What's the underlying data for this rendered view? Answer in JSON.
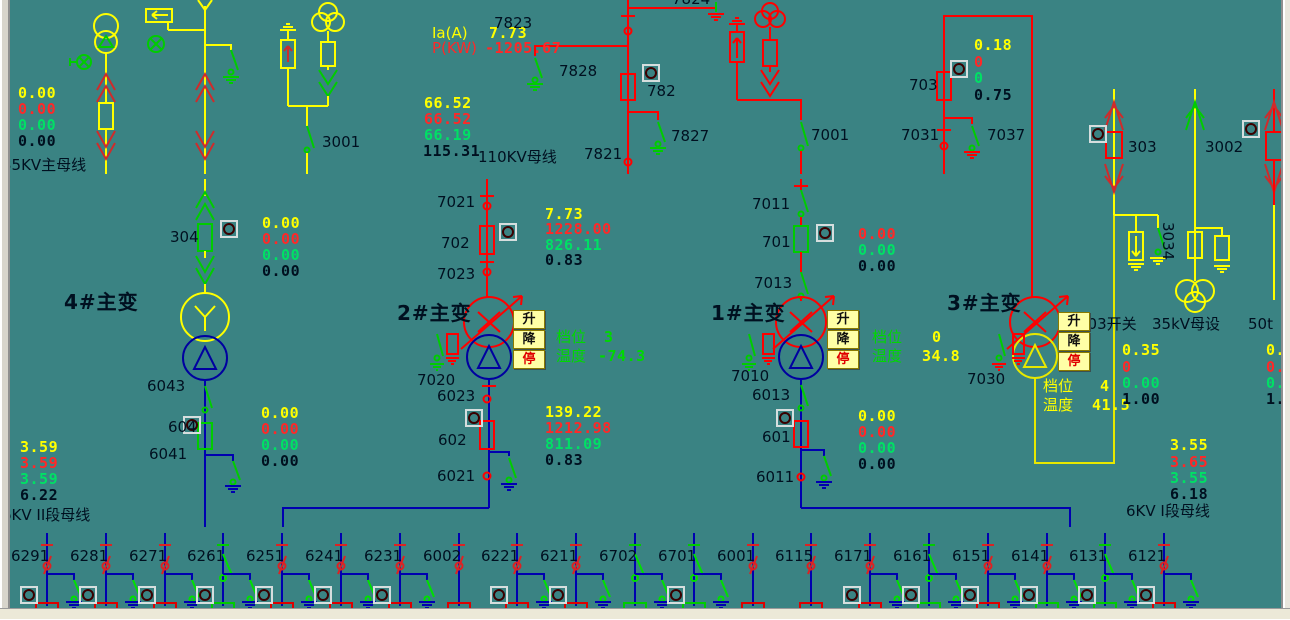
{
  "window": {
    "background": "#3a8383",
    "colors": {
      "yellow": "#ffff00",
      "red": "#ff2828",
      "green": "#00e065",
      "black": "#001020",
      "device_green": "#00cc00",
      "crimson": "#cf2b2b",
      "bus_blue": "#0000cc",
      "line_blue": "#0000b0",
      "navy": "#0000a0",
      "indicator_red": "#ff1515",
      "indicator_green": "#00d800",
      "button_bg": "#ffffa6"
    }
  },
  "tap_buttons": {
    "raise": "升",
    "lower": "降",
    "stop": "停",
    "stop_color": "#e00000",
    "text_color": "#101010"
  },
  "button_groups": [
    {
      "name": "t2-tap-controls",
      "x": 513,
      "y": 310
    },
    {
      "name": "t1-tap-controls",
      "x": 827,
      "y": 310
    },
    {
      "name": "t3-tap-controls",
      "x": 1058,
      "y": 312
    }
  ],
  "indicators": [
    {
      "n": "ind-304",
      "x": 221,
      "y": 221,
      "c": "r"
    },
    {
      "n": "ind-604",
      "x": 184,
      "y": 417,
      "c": "r"
    },
    {
      "n": "ind-702",
      "x": 500,
      "y": 224,
      "c": "r"
    },
    {
      "n": "ind-602",
      "x": 466,
      "y": 410,
      "c": "r"
    },
    {
      "n": "ind-701",
      "x": 817,
      "y": 225,
      "c": "r"
    },
    {
      "n": "ind-601",
      "x": 777,
      "y": 410,
      "c": "r"
    },
    {
      "n": "ind-782",
      "x": 643,
      "y": 65,
      "c": "r"
    },
    {
      "n": "ind-703",
      "x": 951,
      "y": 61,
      "c": "r"
    },
    {
      "n": "ind-303",
      "x": 1090,
      "y": 126,
      "c": "r"
    },
    {
      "n": "ind-50t",
      "x": 1243,
      "y": 121,
      "c": "r"
    }
  ],
  "feeders": {
    "bus_y": 533,
    "items": [
      {
        "id": "6291",
        "x": 47,
        "open": 0,
        "earth": 1,
        "ind": "r",
        "stub": "r"
      },
      {
        "id": "6281",
        "x": 106,
        "open": 0,
        "earth": 1,
        "ind": "r",
        "stub": "r"
      },
      {
        "id": "6271",
        "x": 165,
        "open": 0,
        "earth": 1,
        "ind": "r",
        "stub": "r"
      },
      {
        "id": "6261",
        "x": 223,
        "open": 1,
        "earth": 1,
        "ind": "g",
        "stub": "g"
      },
      {
        "id": "6251",
        "x": 282,
        "open": 0,
        "earth": 1,
        "ind": "r",
        "stub": "r"
      },
      {
        "id": "6241",
        "x": 341,
        "open": 0,
        "earth": 1,
        "ind": "r",
        "stub": "r"
      },
      {
        "id": "6231",
        "x": 400,
        "open": 0,
        "earth": 1,
        "ind": "r",
        "stub": "r"
      },
      {
        "id": "6002",
        "x": 459,
        "open": 0,
        "earth": 0,
        "ind": "",
        "stub": "r"
      },
      {
        "id": "6221",
        "x": 517,
        "open": 0,
        "earth": 1,
        "ind": "r",
        "stub": "r"
      },
      {
        "id": "6211",
        "x": 576,
        "open": 0,
        "earth": 1,
        "ind": "r",
        "stub": "r"
      },
      {
        "id": "6702",
        "x": 635,
        "open": 1,
        "earth": 1,
        "ind": "",
        "stub": "g"
      },
      {
        "id": "6701",
        "x": 694,
        "open": 1,
        "earth": 1,
        "ind": "g",
        "stub": "g"
      },
      {
        "id": "6001",
        "x": 753,
        "open": 0,
        "earth": 0,
        "ind": "",
        "stub": "r"
      },
      {
        "id": "6115",
        "x": 811,
        "open": 0,
        "earth": 0,
        "ind": "",
        "stub": "r"
      },
      {
        "id": "6171",
        "x": 870,
        "open": 0,
        "earth": 1,
        "ind": "g",
        "stub": "r"
      },
      {
        "id": "6161",
        "x": 929,
        "open": 1,
        "earth": 1,
        "ind": "r",
        "stub": "g"
      },
      {
        "id": "6151",
        "x": 988,
        "open": 0,
        "earth": 1,
        "ind": "r",
        "stub": "r"
      },
      {
        "id": "6141",
        "x": 1047,
        "open": 0,
        "earth": 1,
        "ind": "r",
        "stub": "g"
      },
      {
        "id": "6131",
        "x": 1105,
        "open": 1,
        "earth": 1,
        "ind": "r",
        "stub": "g"
      },
      {
        "id": "6121",
        "x": 1164,
        "open": 0,
        "earth": 1,
        "ind": "r",
        "stub": "r"
      }
    ]
  },
  "labels": [
    {
      "n": "val-35kv-ia",
      "t": "0.00",
      "x": 18,
      "y": 85,
      "c": "#ffff00",
      "m": 1
    },
    {
      "n": "val-35kv-p",
      "t": "0.00",
      "x": 18,
      "y": 101,
      "c": "#ff2828",
      "m": 1
    },
    {
      "n": "val-35kv-q",
      "t": "0.00",
      "x": 18,
      "y": 117,
      "c": "#00e065",
      "m": 1
    },
    {
      "n": "val-35kv-cos",
      "t": "0.00",
      "x": 18,
      "y": 133,
      "c": "#001020",
      "m": 1
    },
    {
      "n": "lbl-35kv-bus",
      "t": "35KV主母线",
      "x": 2,
      "y": 157,
      "c": "#001020"
    },
    {
      "n": "lbl-3001",
      "t": "3001",
      "x": 322,
      "y": 134,
      "c": "#001020"
    },
    {
      "n": "lbl-304",
      "t": "304",
      "x": 170,
      "y": 229,
      "c": "#001020"
    },
    {
      "n": "val-304-ia",
      "t": "0.00",
      "x": 262,
      "y": 215,
      "c": "#ffff00",
      "m": 1
    },
    {
      "n": "val-304-p",
      "t": "0.00",
      "x": 262,
      "y": 231,
      "c": "#ff2828",
      "m": 1
    },
    {
      "n": "val-304-q",
      "t": "0.00",
      "x": 262,
      "y": 247,
      "c": "#00e065",
      "m": 1
    },
    {
      "n": "val-304-cos",
      "t": "0.00",
      "x": 262,
      "y": 263,
      "c": "#001020",
      "m": 1
    },
    {
      "n": "name-t4",
      "t": "4#主变",
      "x": 64,
      "y": 294,
      "c": "#001020",
      "b": 1
    },
    {
      "n": "lbl-6043",
      "t": "6043",
      "x": 147,
      "y": 378,
      "c": "#001020"
    },
    {
      "n": "lbl-604",
      "t": "604",
      "x": 168,
      "y": 419,
      "c": "#001020"
    },
    {
      "n": "lbl-6041",
      "t": "6041",
      "x": 149,
      "y": 446,
      "c": "#001020"
    },
    {
      "n": "val-604-ia",
      "t": "0.00",
      "x": 261,
      "y": 405,
      "c": "#ffff00",
      "m": 1
    },
    {
      "n": "val-604-p",
      "t": "0.00",
      "x": 261,
      "y": 421,
      "c": "#ff2828",
      "m": 1
    },
    {
      "n": "val-604-q",
      "t": "0.00",
      "x": 261,
      "y": 437,
      "c": "#00e065",
      "m": 1
    },
    {
      "n": "val-604-cos",
      "t": "0.00",
      "x": 261,
      "y": 453,
      "c": "#001020",
      "m": 1
    },
    {
      "n": "val-bus2-ua",
      "t": "3.59",
      "x": 20,
      "y": 439,
      "c": "#ffff00",
      "m": 1
    },
    {
      "n": "val-bus2-ub",
      "t": "3.59",
      "x": 20,
      "y": 455,
      "c": "#ff2828",
      "m": 1
    },
    {
      "n": "val-bus2-uc",
      "t": "3.59",
      "x": 20,
      "y": 471,
      "c": "#00e065",
      "m": 1
    },
    {
      "n": "val-bus2-uab",
      "t": "6.22",
      "x": 20,
      "y": 487,
      "c": "#001020",
      "m": 1
    },
    {
      "n": "lbl-bus-6kv2",
      "t": "6KV II段母线",
      "x": 2,
      "y": 507,
      "c": "#001020"
    },
    {
      "n": "lbl-ia-a",
      "t": "Ia(A)",
      "x": 432,
      "y": 25,
      "c": "#ffff00"
    },
    {
      "n": "val-ia-a",
      "t": "7.73",
      "x": 489,
      "y": 25,
      "c": "#ffff00",
      "m": 1
    },
    {
      "n": "lbl-p-kw",
      "t": "P(KW)",
      "x": 432,
      "y": 40,
      "c": "#ff2828"
    },
    {
      "n": "val-p-kw",
      "t": "-1205.67",
      "x": 485,
      "y": 40,
      "c": "#ff2828",
      "m": 1
    },
    {
      "n": "val-110-ua",
      "t": "66.52",
      "x": 424,
      "y": 95,
      "c": "#ffff00",
      "m": 1
    },
    {
      "n": "val-110-ub",
      "t": "66.52",
      "x": 424,
      "y": 111,
      "c": "#ff2828",
      "m": 1
    },
    {
      "n": "val-110-uc",
      "t": "66.19",
      "x": 424,
      "y": 127,
      "c": "#00e065",
      "m": 1
    },
    {
      "n": "val-110-uab",
      "t": "115.31",
      "x": 423,
      "y": 143,
      "c": "#001020",
      "m": 1
    },
    {
      "n": "lbl-110kv-bus",
      "t": "110KV母线",
      "x": 478,
      "y": 149,
      "c": "#001020"
    },
    {
      "n": "lbl-7823",
      "t": "7823",
      "x": 494,
      "y": 15,
      "c": "#001020"
    },
    {
      "n": "lbl-7824",
      "t": "7824",
      "x": 672,
      "y": -9,
      "c": "#001020"
    },
    {
      "n": "lbl-7828",
      "t": "7828",
      "x": 559,
      "y": 63,
      "c": "#001020"
    },
    {
      "n": "lbl-782",
      "t": "782",
      "x": 647,
      "y": 83,
      "c": "#001020"
    },
    {
      "n": "lbl-7827",
      "t": "7827",
      "x": 671,
      "y": 128,
      "c": "#001020"
    },
    {
      "n": "lbl-7821",
      "t": "7821",
      "x": 584,
      "y": 146,
      "c": "#001020"
    },
    {
      "n": "lbl-7021",
      "t": "7021",
      "x": 437,
      "y": 194,
      "c": "#001020"
    },
    {
      "n": "lbl-702",
      "t": "702",
      "x": 441,
      "y": 235,
      "c": "#001020"
    },
    {
      "n": "lbl-7023",
      "t": "7023",
      "x": 437,
      "y": 266,
      "c": "#001020"
    },
    {
      "n": "name-t2",
      "t": "2#主变",
      "x": 397,
      "y": 305,
      "c": "#001020",
      "b": 1
    },
    {
      "n": "lbl-7020",
      "t": "7020",
      "x": 417,
      "y": 372,
      "c": "#001020"
    },
    {
      "n": "lbl-6023",
      "t": "6023",
      "x": 437,
      "y": 388,
      "c": "#001020"
    },
    {
      "n": "lbl-602",
      "t": "602",
      "x": 438,
      "y": 432,
      "c": "#001020"
    },
    {
      "n": "lbl-6021",
      "t": "6021",
      "x": 437,
      "y": 468,
      "c": "#001020"
    },
    {
      "n": "val-702-ia",
      "t": "7.73",
      "x": 545,
      "y": 206,
      "c": "#ffff00",
      "m": 1
    },
    {
      "n": "val-702-p",
      "t": "1228.00",
      "x": 545,
      "y": 221,
      "c": "#ff2828",
      "m": 1
    },
    {
      "n": "val-702-q",
      "t": "826.11",
      "x": 545,
      "y": 237,
      "c": "#00e065",
      "m": 1
    },
    {
      "n": "val-702-cos",
      "t": "0.83",
      "x": 545,
      "y": 252,
      "c": "#001020",
      "m": 1
    },
    {
      "n": "val-602-ia",
      "t": "139.22",
      "x": 545,
      "y": 404,
      "c": "#ffff00",
      "m": 1
    },
    {
      "n": "val-602-p",
      "t": "1212.98",
      "x": 545,
      "y": 420,
      "c": "#ff2828",
      "m": 1
    },
    {
      "n": "val-602-q",
      "t": "811.09",
      "x": 545,
      "y": 436,
      "c": "#00e065",
      "m": 1
    },
    {
      "n": "val-602-cos",
      "t": "0.83",
      "x": 545,
      "y": 452,
      "c": "#001020",
      "m": 1
    },
    {
      "n": "t2-tap-label",
      "t": "档位",
      "x": 556,
      "y": 329,
      "c": "#00d800"
    },
    {
      "n": "t2-tap-value",
      "t": "3",
      "x": 604,
      "y": 329,
      "c": "#00d800",
      "m": 1
    },
    {
      "n": "t2-temp-label",
      "t": "温度",
      "x": 556,
      "y": 348,
      "c": "#00d800"
    },
    {
      "n": "t2-temp-value",
      "t": "-74.3",
      "x": 598,
      "y": 348,
      "c": "#00d800",
      "m": 1
    },
    {
      "n": "lbl-7011",
      "t": "7011",
      "x": 752,
      "y": 196,
      "c": "#001020"
    },
    {
      "n": "lbl-701",
      "t": "701",
      "x": 762,
      "y": 234,
      "c": "#001020"
    },
    {
      "n": "lbl-7013",
      "t": "7013",
      "x": 754,
      "y": 275,
      "c": "#001020"
    },
    {
      "n": "name-t1",
      "t": "1#主变",
      "x": 711,
      "y": 305,
      "c": "#001020",
      "b": 1
    },
    {
      "n": "lbl-7010",
      "t": "7010",
      "x": 731,
      "y": 368,
      "c": "#001020"
    },
    {
      "n": "lbl-6013",
      "t": "6013",
      "x": 752,
      "y": 387,
      "c": "#001020"
    },
    {
      "n": "lbl-601",
      "t": "601",
      "x": 762,
      "y": 429,
      "c": "#001020"
    },
    {
      "n": "lbl-6011",
      "t": "6011",
      "x": 756,
      "y": 469,
      "c": "#001020"
    },
    {
      "n": "val-701-p",
      "t": "0.00",
      "x": 858,
      "y": 226,
      "c": "#ff2828",
      "m": 1
    },
    {
      "n": "val-701-q",
      "t": "0.00",
      "x": 858,
      "y": 242,
      "c": "#00e065",
      "m": 1
    },
    {
      "n": "val-701-cos",
      "t": "0.00",
      "x": 858,
      "y": 258,
      "c": "#001020",
      "m": 1
    },
    {
      "n": "val-601-ia",
      "t": "0.00",
      "x": 858,
      "y": 408,
      "c": "#ffff00",
      "m": 1
    },
    {
      "n": "val-601-p",
      "t": "0.00",
      "x": 858,
      "y": 424,
      "c": "#ff2828",
      "m": 1
    },
    {
      "n": "val-601-q",
      "t": "0.00",
      "x": 858,
      "y": 440,
      "c": "#00e065",
      "m": 1
    },
    {
      "n": "val-601-cos",
      "t": "0.00",
      "x": 858,
      "y": 456,
      "c": "#001020",
      "m": 1
    },
    {
      "n": "t1-tap-label",
      "t": "档位",
      "x": 872,
      "y": 329,
      "c": "#00d800"
    },
    {
      "n": "t1-tap-value",
      "t": "0",
      "x": 932,
      "y": 329,
      "c": "#ffff00",
      "m": 1
    },
    {
      "n": "t1-temp-label",
      "t": "温度",
      "x": 872,
      "y": 348,
      "c": "#00d800"
    },
    {
      "n": "t1-temp-value",
      "t": "34.8",
      "x": 922,
      "y": 348,
      "c": "#ffff00",
      "m": 1
    },
    {
      "n": "lbl-703",
      "t": "703",
      "x": 909,
      "y": 77,
      "c": "#001020"
    },
    {
      "n": "lbl-7031",
      "t": "7031",
      "x": 901,
      "y": 127,
      "c": "#001020"
    },
    {
      "n": "lbl-7037",
      "t": "7037",
      "x": 987,
      "y": 127,
      "c": "#001020"
    },
    {
      "n": "val-703-ia",
      "t": "0.18",
      "x": 974,
      "y": 37,
      "c": "#ffff00",
      "m": 1
    },
    {
      "n": "val-703-p",
      "t": "0",
      "x": 974,
      "y": 54,
      "c": "#ff2828",
      "m": 1
    },
    {
      "n": "val-703-q",
      "t": "0",
      "x": 974,
      "y": 70,
      "c": "#00e065",
      "m": 1
    },
    {
      "n": "val-703-cos",
      "t": "0.75",
      "x": 974,
      "y": 87,
      "c": "#001020",
      "m": 1
    },
    {
      "n": "lbl-7001",
      "t": "7001",
      "x": 811,
      "y": 127,
      "c": "#001020"
    },
    {
      "n": "name-t3",
      "t": "3#主变",
      "x": 947,
      "y": 295,
      "c": "#001020",
      "b": 1
    },
    {
      "n": "lbl-7030",
      "t": "7030",
      "x": 967,
      "y": 371,
      "c": "#001020"
    },
    {
      "n": "t3-tap-label",
      "t": "档位",
      "x": 1043,
      "y": 378,
      "c": "#ffff00"
    },
    {
      "n": "t3-tap-value",
      "t": "4",
      "x": 1100,
      "y": 378,
      "c": "#ffff00",
      "m": 1
    },
    {
      "n": "t3-temp-label",
      "t": "温度",
      "x": 1043,
      "y": 397,
      "c": "#ffff00"
    },
    {
      "n": "t3-temp-value",
      "t": "41.5",
      "x": 1092,
      "y": 397,
      "c": "#ffff00",
      "m": 1
    },
    {
      "n": "lbl-303-switch",
      "t": "303开关",
      "x": 1078,
      "y": 316,
      "c": "#001020"
    },
    {
      "n": "lbl-35kv-mushe",
      "t": "35kV母设",
      "x": 1152,
      "y": 316,
      "c": "#001020"
    },
    {
      "n": "lbl-50t",
      "t": "50t",
      "x": 1248,
      "y": 316,
      "c": "#001020"
    },
    {
      "n": "val-303-ia",
      "t": "0.35",
      "x": 1122,
      "y": 342,
      "c": "#ffff00",
      "m": 1
    },
    {
      "n": "val-303-p",
      "t": "0",
      "x": 1122,
      "y": 359,
      "c": "#ff2828",
      "m": 1
    },
    {
      "n": "val-303-q",
      "t": "0.00",
      "x": 1122,
      "y": 375,
      "c": "#00e065",
      "m": 1
    },
    {
      "n": "val-303-cos",
      "t": "1.00",
      "x": 1122,
      "y": 391,
      "c": "#001020",
      "m": 1
    },
    {
      "n": "val-50t-ia",
      "t": "0.3",
      "x": 1266,
      "y": 342,
      "c": "#ffff00",
      "m": 1
    },
    {
      "n": "val-50t-p",
      "t": "0.",
      "x": 1266,
      "y": 359,
      "c": "#ff2828",
      "m": 1
    },
    {
      "n": "val-50t-q",
      "t": "0.0",
      "x": 1266,
      "y": 375,
      "c": "#00e065",
      "m": 1
    },
    {
      "n": "val-50t-cos",
      "t": "1.",
      "x": 1266,
      "y": 391,
      "c": "#001020",
      "m": 1
    },
    {
      "n": "lbl-303",
      "t": "303",
      "x": 1128,
      "y": 139,
      "c": "#001020"
    },
    {
      "n": "lbl-3002",
      "t": "3002",
      "x": 1205,
      "y": 139,
      "c": "#001020"
    },
    {
      "n": "lbl-3034",
      "t": "3034",
      "x": 1176,
      "y": 222,
      "c": "#001020",
      "r": 1
    },
    {
      "n": "val-bus1-ua",
      "t": "3.55",
      "x": 1170,
      "y": 437,
      "c": "#ffff00",
      "m": 1
    },
    {
      "n": "val-bus1-ub",
      "t": "3.65",
      "x": 1170,
      "y": 454,
      "c": "#ff2828",
      "m": 1
    },
    {
      "n": "val-bus1-uc",
      "t": "3.55",
      "x": 1170,
      "y": 470,
      "c": "#00e065",
      "m": 1
    },
    {
      "n": "val-bus1-uab",
      "t": "6.18",
      "x": 1170,
      "y": 486,
      "c": "#001020",
      "m": 1
    },
    {
      "n": "lbl-bus-6kv1",
      "t": "6KV I段母线",
      "x": 1126,
      "y": 503,
      "c": "#001020"
    }
  ]
}
